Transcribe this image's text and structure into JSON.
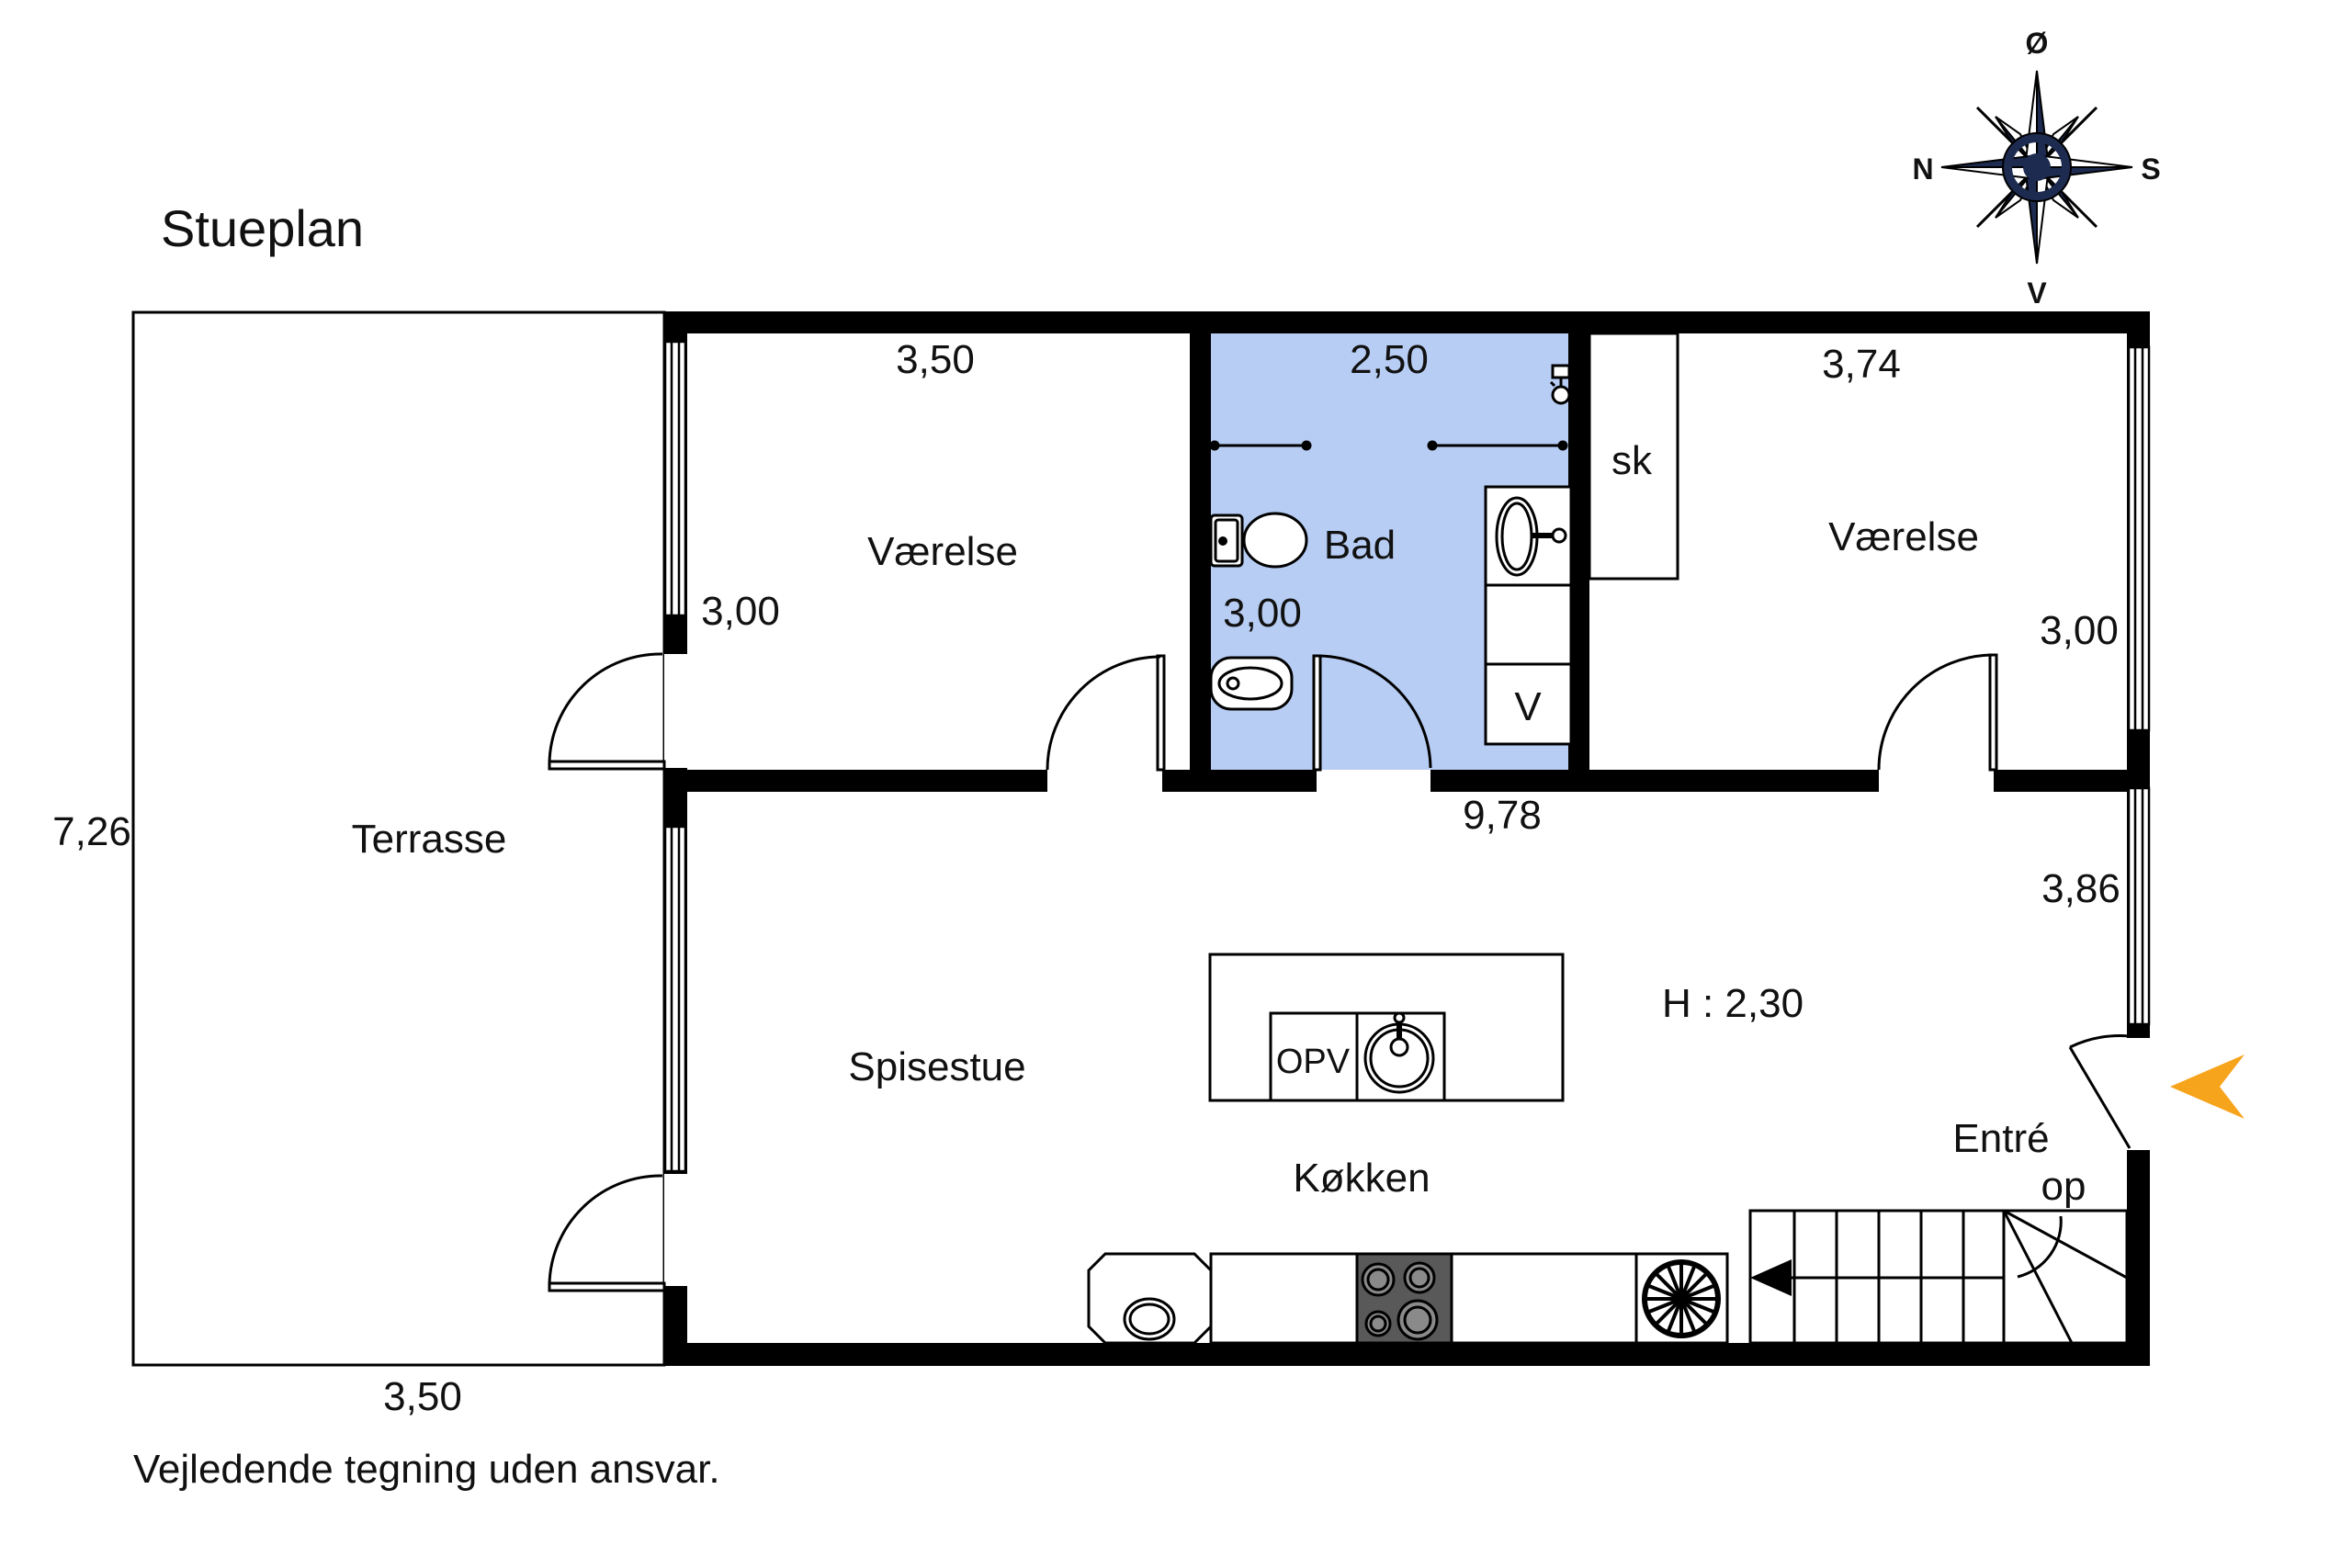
{
  "title": "Stueplan",
  "footer_note": "Vejledende tegning uden ansvar.",
  "compass": {
    "north": "N",
    "south": "S",
    "east": "Ø",
    "west": "V"
  },
  "colors": {
    "bath_fill": "#b7cdf3",
    "accent_arrow": "#f7a41d",
    "compass_navy": "#1d2b50",
    "stove_gray": "#595959"
  },
  "rooms": {
    "terrasse": {
      "label": "Terrasse",
      "width_label": "3,50",
      "height_label": "7,26"
    },
    "vaerelse_left": {
      "label": "Værelse",
      "width_label": "3,50",
      "height_label": "3,00"
    },
    "bad": {
      "label": "Bad",
      "width_label": "2,50",
      "height_label": "3,00",
      "washer_label": "V"
    },
    "closet": {
      "label": "sk"
    },
    "vaerelse_right": {
      "label": "Værelse",
      "width_label": "3,74",
      "height_label": "3,00"
    },
    "spisestue": {
      "label": "Spisestue"
    },
    "koekken": {
      "label": "Køkken",
      "island_label": "OPV"
    },
    "entre": {
      "label": "Entré",
      "stairs_label": "op"
    }
  },
  "dimensions": {
    "lower_width": "9,78",
    "right_height": "3,86",
    "ceiling_height": "H : 2,30"
  }
}
